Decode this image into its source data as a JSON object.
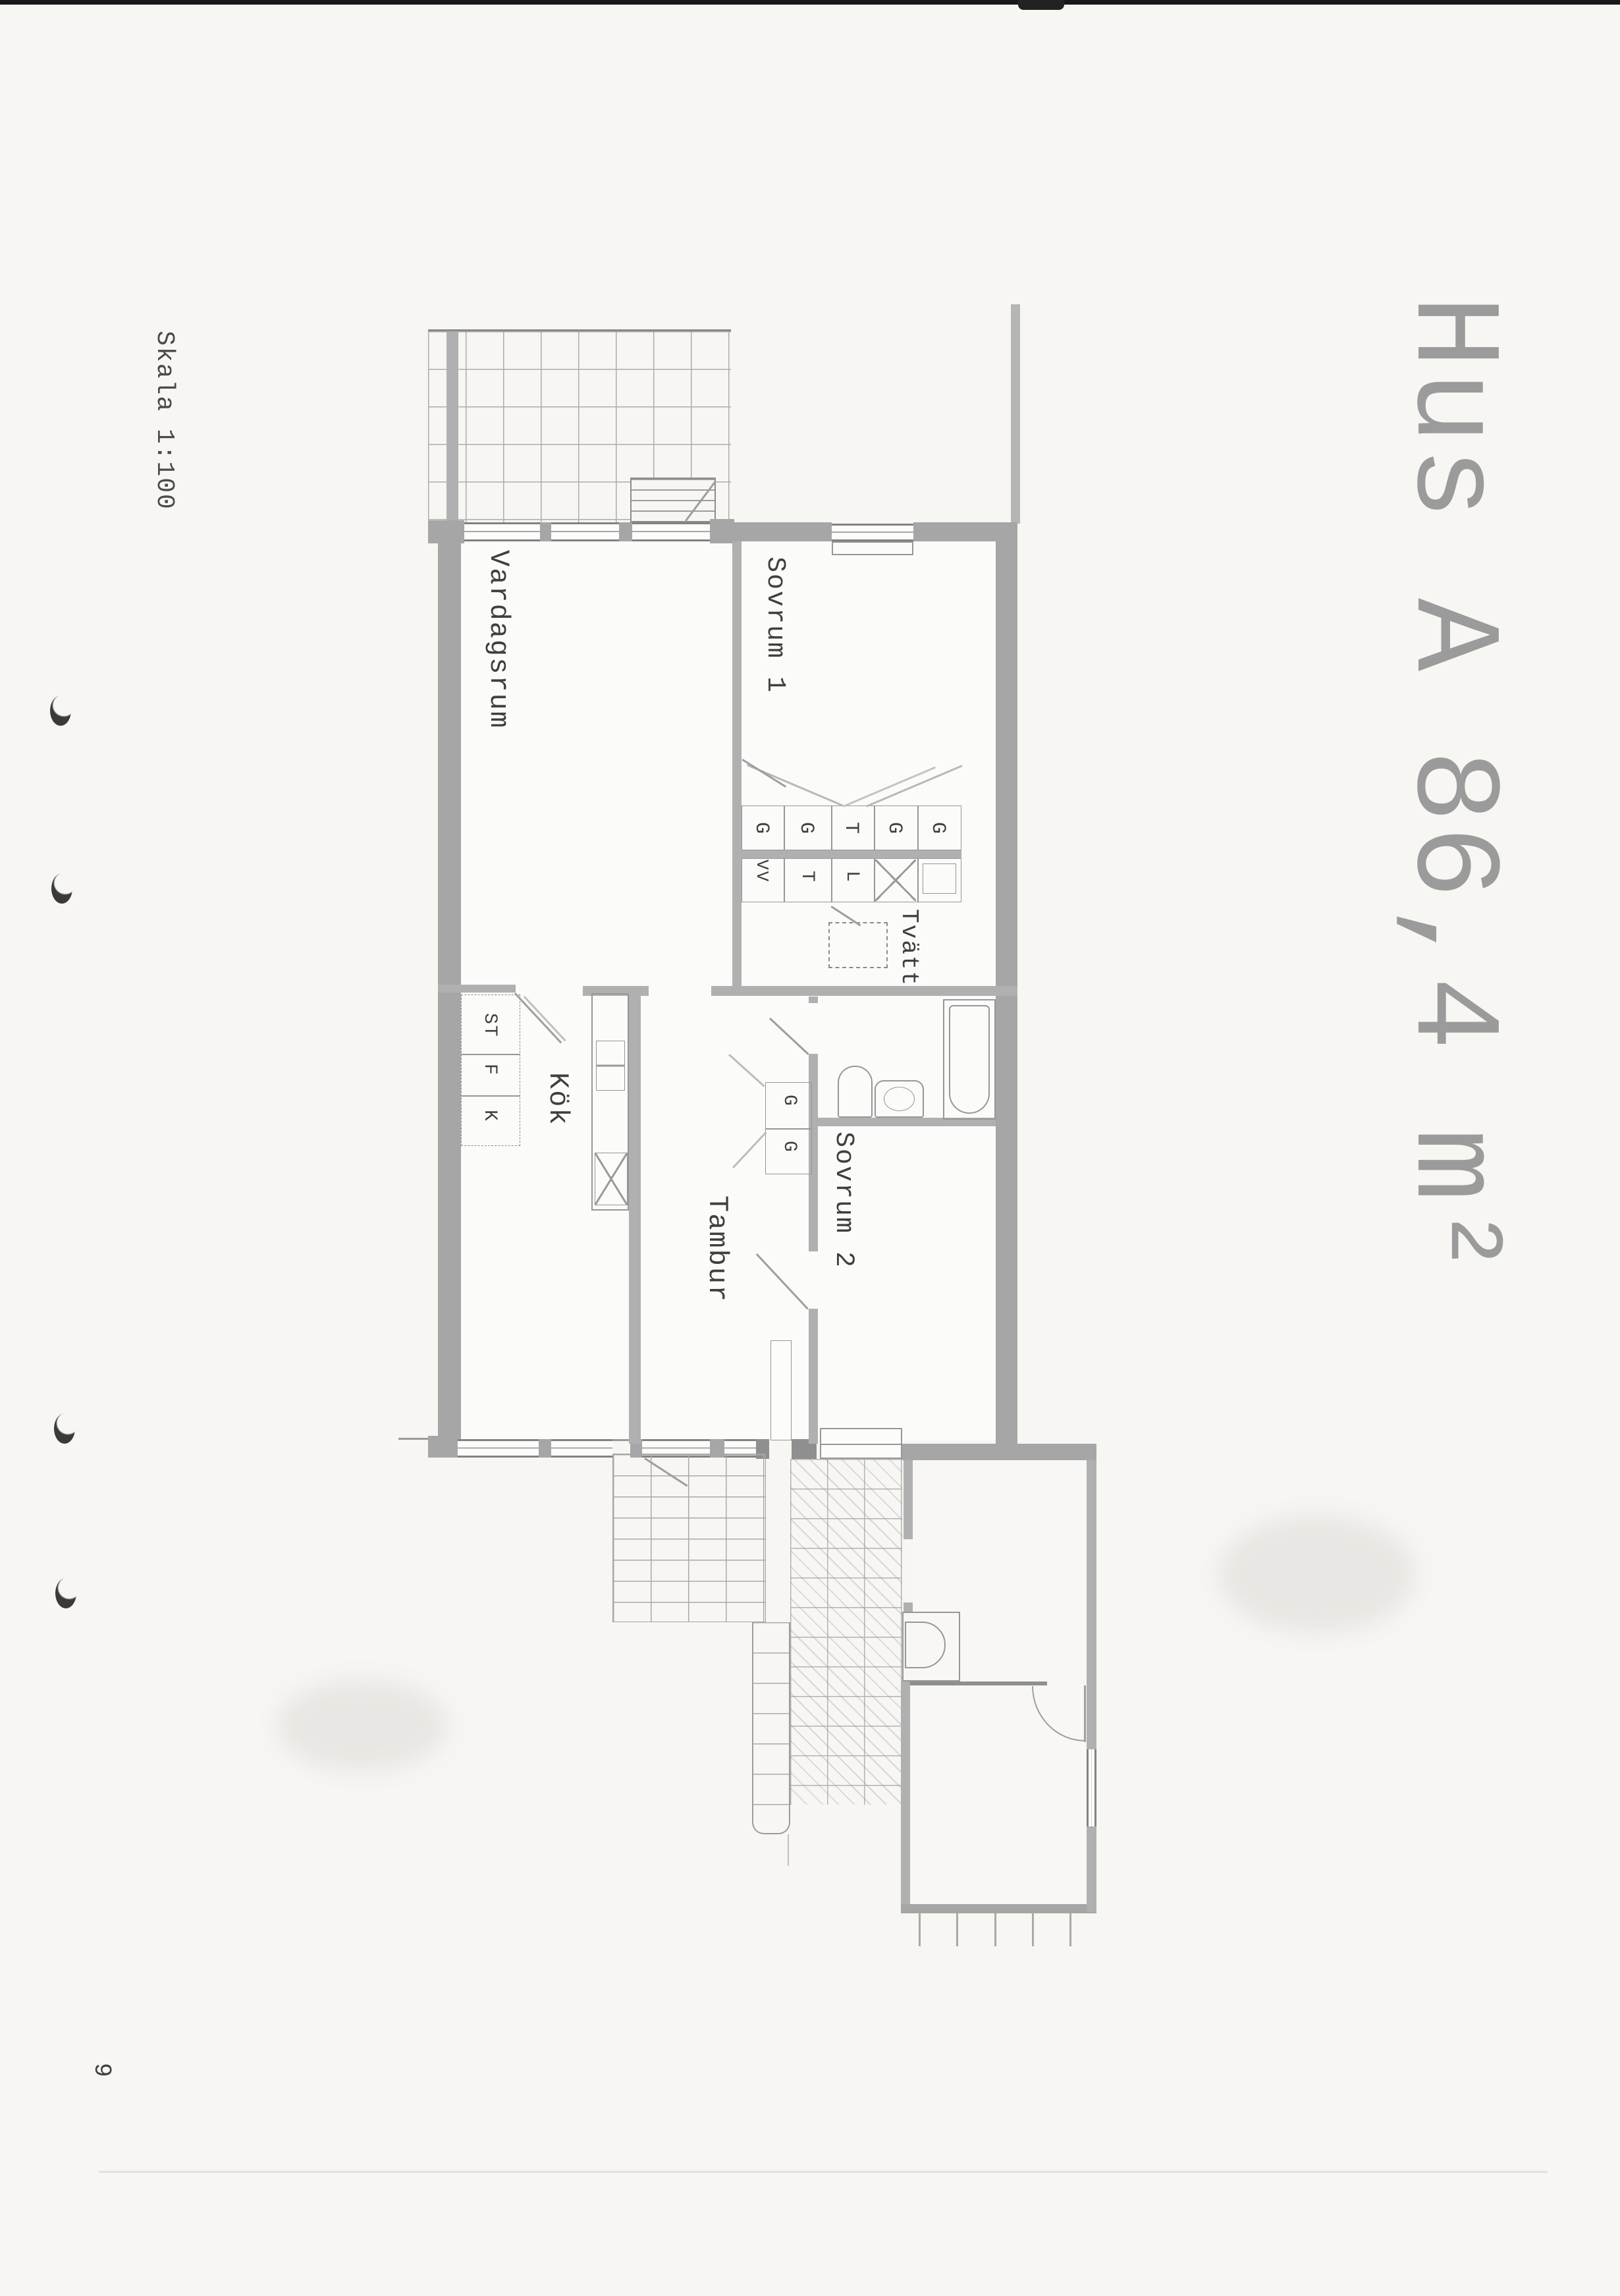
{
  "title": "Hus A 86,4 m²",
  "scale": "Skala 1:100",
  "page_number": "9",
  "rooms": {
    "vardagsrum": "Vardagsrum",
    "sovrum1": "Sovrum 1",
    "tvatt": "Tvätt",
    "kok": "Kök",
    "tambur": "Tambur",
    "sovrum2": "Sovrum 2",
    "forrad": "Förrad"
  },
  "closets": {
    "bedroom_row": [
      "G",
      "G",
      "T",
      "G",
      "G"
    ],
    "laundry_row": [
      "VV",
      "T",
      "L"
    ],
    "kitchen_column": [
      "ST",
      "F",
      "K"
    ],
    "hall_pair": [
      "G",
      "G"
    ]
  },
  "colors": {
    "paper": "#f7f6f3",
    "wall_gray": "#a6a6a6",
    "line_gray": "#8b8b8b",
    "text_dark": "#3f3f3f",
    "title_gray": "#9b9b9b"
  }
}
